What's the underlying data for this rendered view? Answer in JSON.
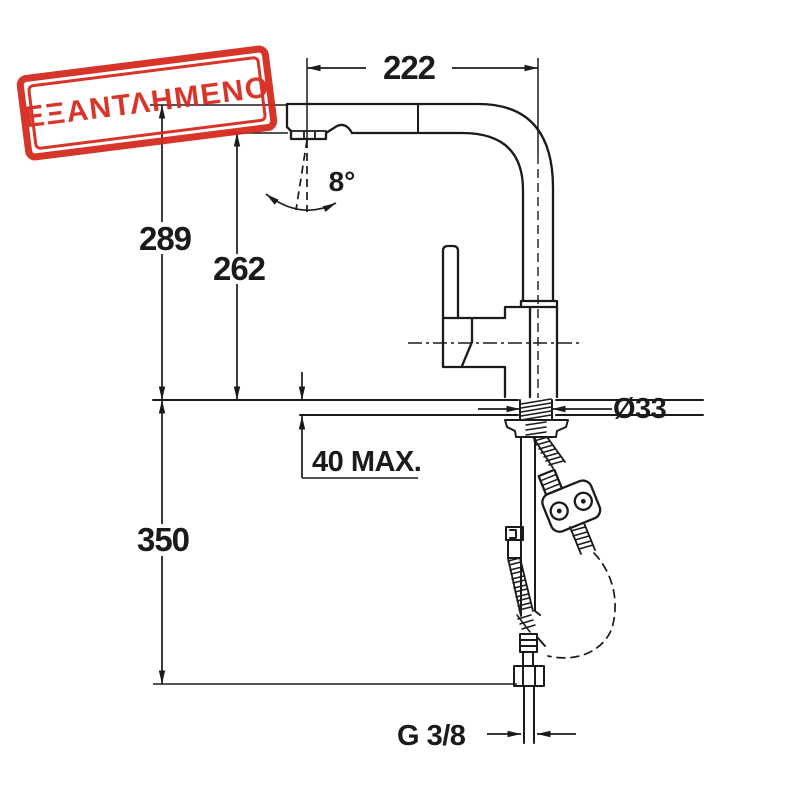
{
  "stamp": {
    "text": "ΕΞΑΝΤΛΗΜΕΝΟ",
    "color": "#d5291d"
  },
  "drawing": {
    "subject": "pull-out-kitchen-faucet-technical-drawing",
    "line_color": "#1b1b1b",
    "dimensions": {
      "spout_reach": "222",
      "overall_height": "289",
      "outlet_height": "262",
      "spray_angle": "8°",
      "max_counter_thickness": "40 MAX.",
      "hole_diameter": "Ø33",
      "hose_drop": "350",
      "connection_thread": "G 3/8"
    }
  }
}
